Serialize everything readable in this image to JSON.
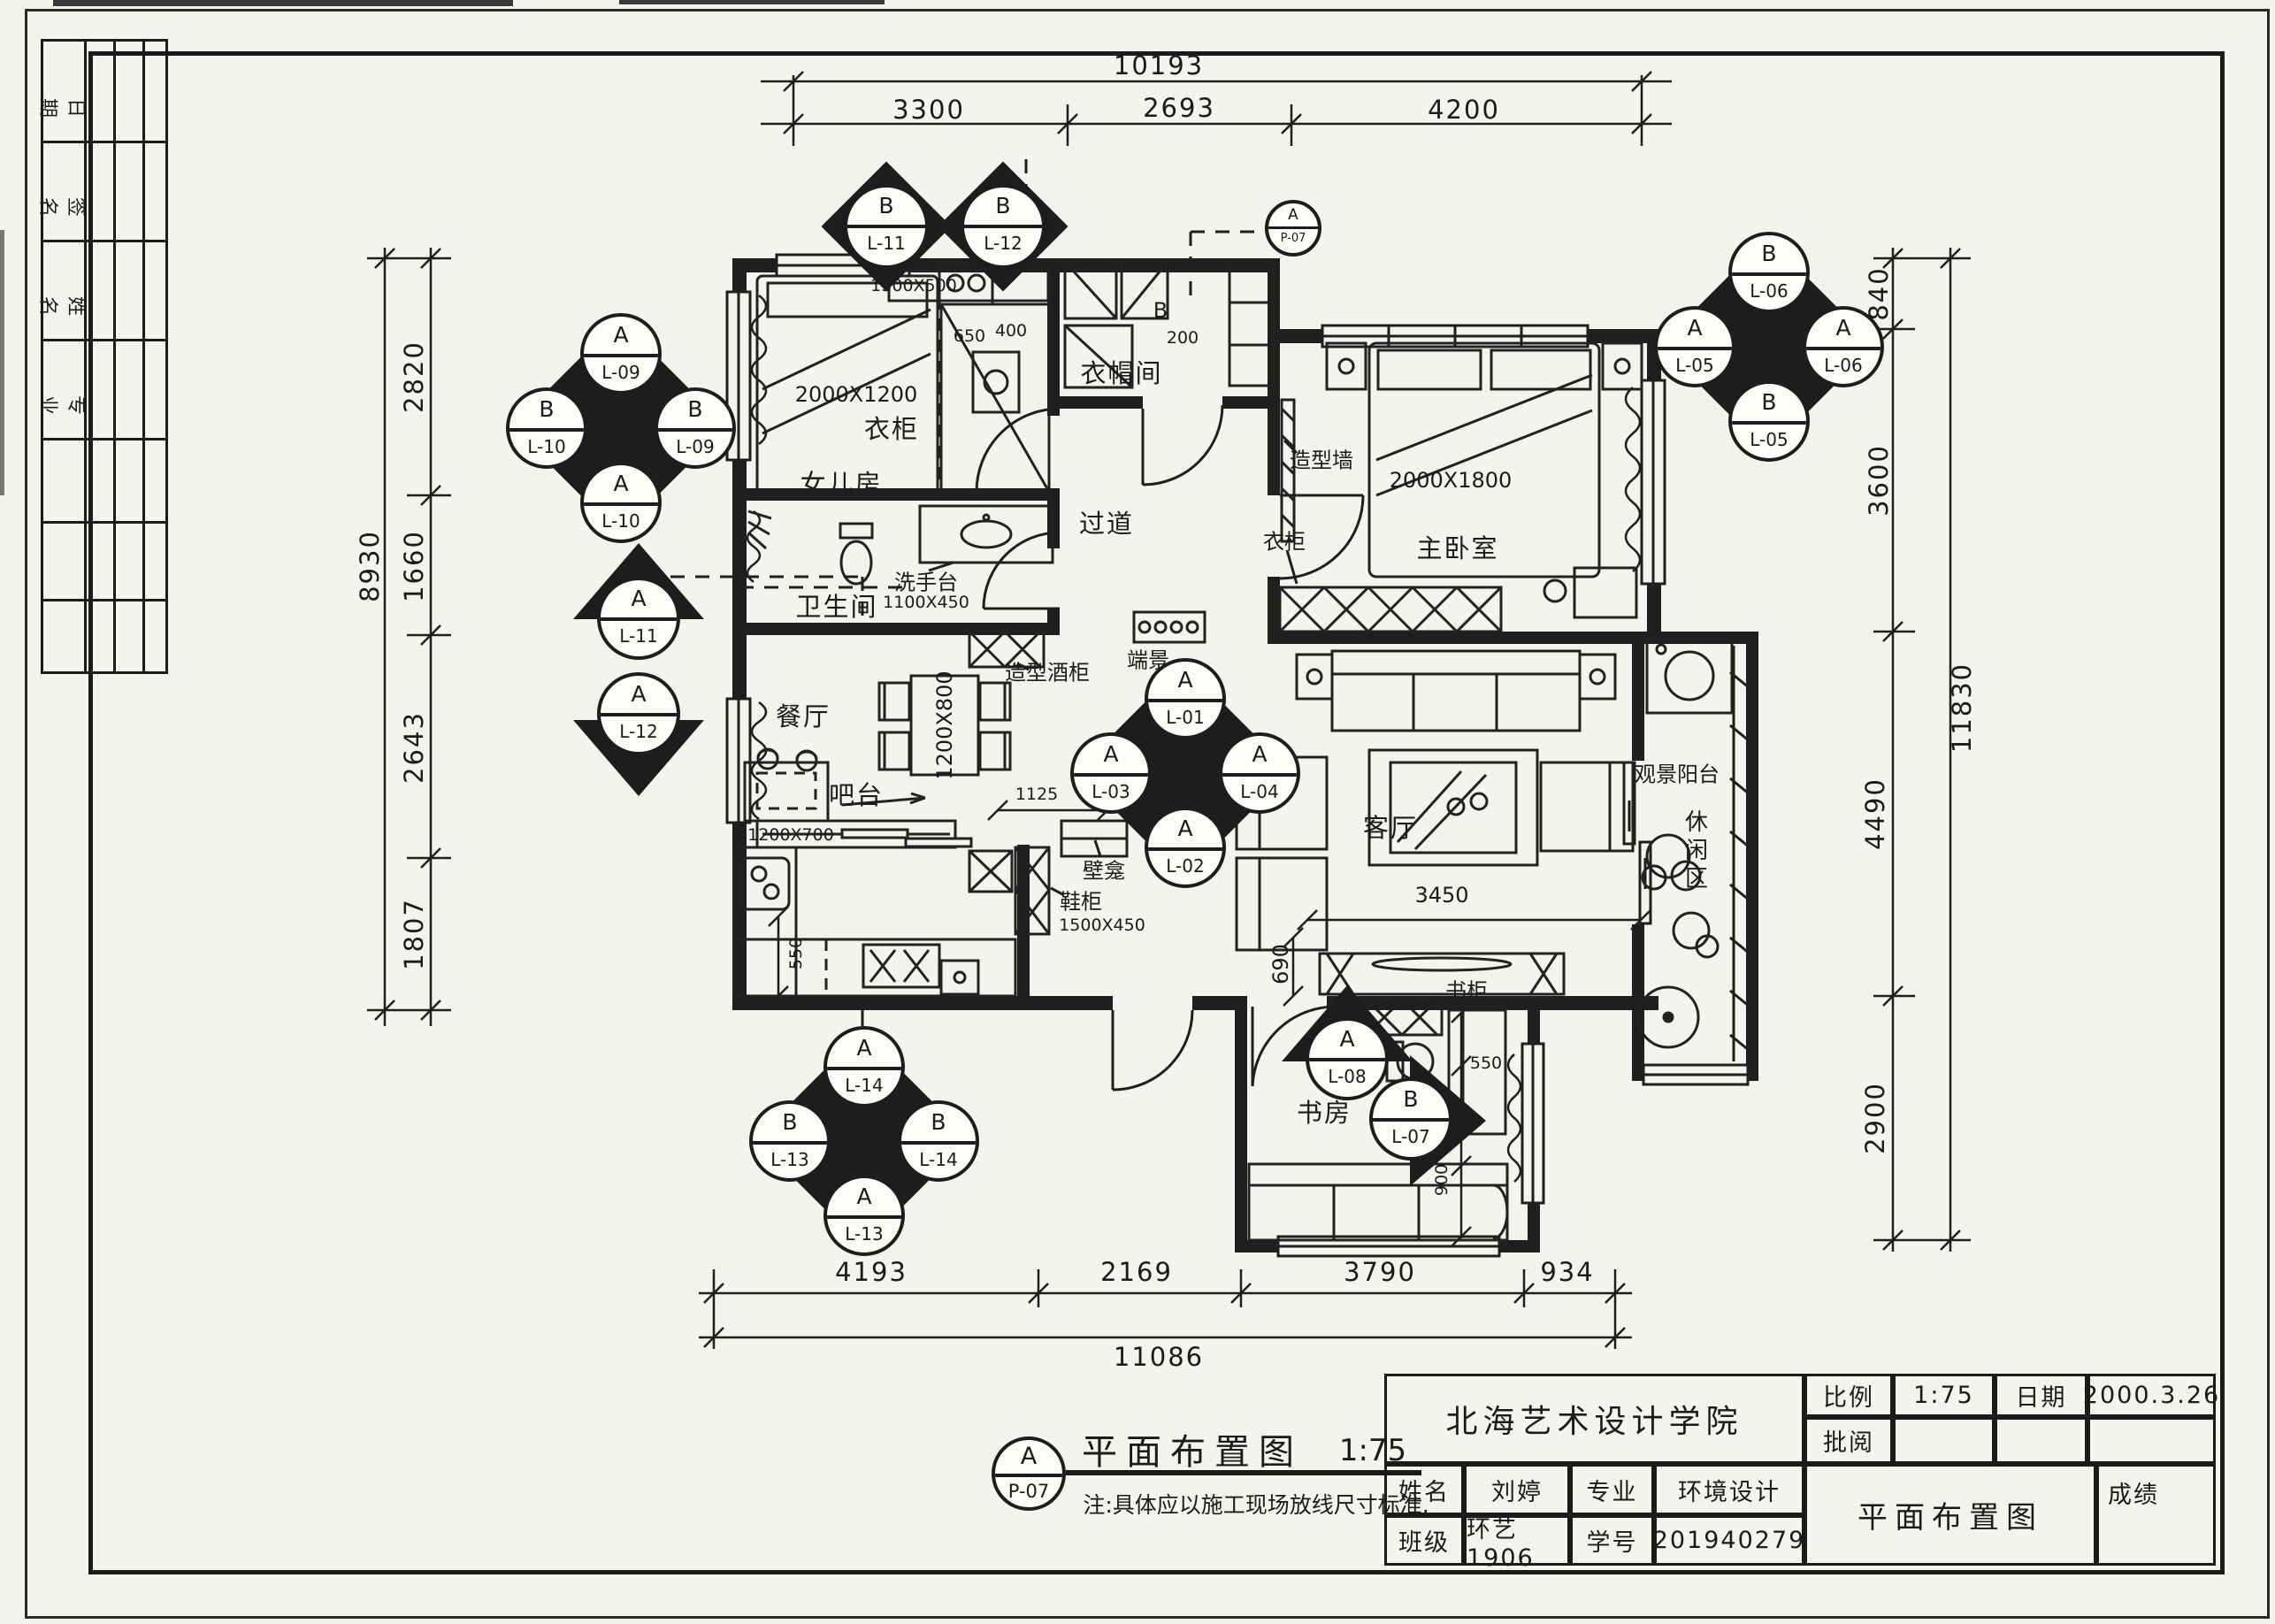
{
  "sheet": {
    "side_strip": {
      "rows": [
        "日期",
        "签名",
        "姓名",
        "专业"
      ]
    },
    "legend": {
      "symbol_top": "A",
      "symbol_bottom": "P-07",
      "title": "平面布置图",
      "scale": "1:75",
      "note": "注:具体应以施工现场放线尺寸标准."
    },
    "title_block": {
      "school": "北海艺术设计学院",
      "scale_label": "比例",
      "scale_value": "1:75",
      "date_label": "日期",
      "date_value": "2000.3.26",
      "review_label": "批阅",
      "name_label": "姓名",
      "name_value": "刘婷",
      "major_label": "专业",
      "major_value": "环境设计",
      "class_label": "班级",
      "class_value": "环艺1906",
      "sid_label": "学号",
      "sid_value": "201940279",
      "drawing_title": "平面布置图",
      "grade_label": "成绩"
    }
  },
  "dims": {
    "top": {
      "overall": "10193",
      "segs": [
        "3300",
        "2693",
        "4200"
      ]
    },
    "left": {
      "overall": "8930",
      "segs": [
        "2820",
        "1660",
        "2643",
        "1807"
      ]
    },
    "right": {
      "overall": "11830",
      "segs": [
        "840",
        "3600",
        "4490",
        "2900"
      ]
    },
    "bottom": {
      "overall": "11086",
      "segs": [
        "4193",
        "2169",
        "3790",
        "934"
      ]
    },
    "inner": {
      "living_w": "3450",
      "tv_d": "690",
      "bar1": "1125",
      "bar2": "240",
      "kitchen": "550",
      "study_top": "550",
      "study_mid": "1880",
      "study_bot": "900",
      "closet_a": "650",
      "closet_b": "400",
      "closet_c": "200"
    }
  },
  "rooms": {
    "daughter": "女儿房",
    "cloak": "衣帽间",
    "cloak_b": "B",
    "master": "主卧室",
    "bath": "卫生间",
    "corridor": "过道",
    "vista": "端景",
    "dining": "餐厅",
    "bar": "吧台",
    "living": "客厅",
    "balcony": "观景阳台",
    "leisure": "休闲区",
    "study": "书房"
  },
  "furniture": {
    "wardrobe1": "衣柜",
    "wardrobe2": "衣柜",
    "feature_wall": "造型墙",
    "wine_cabinet": "造型酒柜",
    "niche": "壁龛",
    "shoe": "鞋柜",
    "bookcase": "书柜",
    "basin": "洗手台"
  },
  "sizes": {
    "bed1": "2000X1200",
    "bed1_head": "1300X500",
    "bed2": "2000X1800",
    "basin": "1100X450",
    "table": "1200X800",
    "counter": "1200X700",
    "shoe": "1500X450"
  },
  "markers": {
    "tl": {
      "top": [
        "A",
        "L-09"
      ],
      "left": [
        "B",
        "L-10"
      ],
      "right": [
        "B",
        "L-09"
      ],
      "bottom": [
        "A",
        "L-10"
      ]
    },
    "top1": [
      "B",
      "L-11"
    ],
    "top2": [
      "B",
      "L-12"
    ],
    "ref": [
      "A",
      "P-07"
    ],
    "tr": {
      "top": [
        "B",
        "L-06"
      ],
      "left": [
        "A",
        "L-05"
      ],
      "right": [
        "A",
        "L-06"
      ],
      "bottom": [
        "B",
        "L-05"
      ]
    },
    "ml1": [
      "A",
      "L-11"
    ],
    "ml2": [
      "A",
      "L-12"
    ],
    "center": {
      "top": [
        "A",
        "L-01"
      ],
      "left": [
        "A",
        "L-03"
      ],
      "right": [
        "A",
        "L-04"
      ],
      "bottom": [
        "A",
        "L-02"
      ]
    },
    "bl": {
      "top": [
        "A",
        "L-14"
      ],
      "left": [
        "B",
        "L-13"
      ],
      "right": [
        "B",
        "L-14"
      ],
      "bottom": [
        "A",
        "L-13"
      ]
    },
    "study1": [
      "A",
      "L-08"
    ],
    "study2": [
      "B",
      "L-07"
    ]
  }
}
